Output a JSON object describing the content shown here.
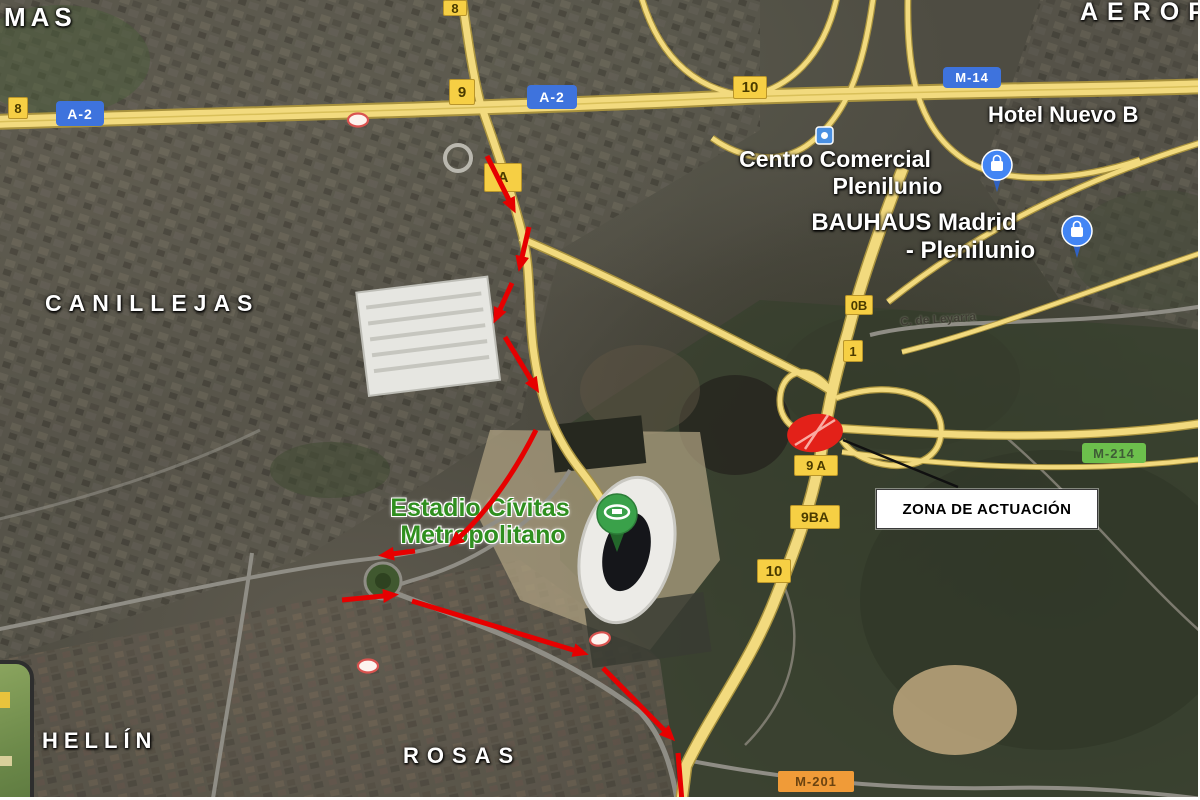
{
  "map_type": "satellite",
  "road_badges": {
    "exit_8_left": "8",
    "a2_left": "A-2",
    "exit_8_top": "8",
    "exit_9": "9",
    "a2_center": "A-2",
    "exit_10_top": "10",
    "exit_a": "A",
    "m14": "M-14",
    "exit_0b": "0B",
    "exit_1": "1",
    "exit_9a": "9 A",
    "exit_9ba": "9BA",
    "exit_10_mid": "10",
    "m214": "M-214",
    "m201": "M-201"
  },
  "place_labels": {
    "mas": "MAS",
    "aerop": "AEROP",
    "hotel_nuevo": "Hotel Nuevo B",
    "centro_comercial_1": "Centro Comercial",
    "centro_comercial_2": "Plenilunio",
    "bauhaus_1": "BAUHAUS Madrid",
    "bauhaus_2": "- Plenilunio",
    "canillejas": "CANILLEJAS",
    "street_leyarra": "C. de Leyarra",
    "estadio_1": "Estadio Cívitas",
    "estadio_2": "Metropolitano",
    "hellin": "HELLÍN",
    "rosas": "ROSAS"
  },
  "annotation": {
    "zona_label": "ZONA DE ACTUACIÓN"
  },
  "colors": {
    "exit_badge_yellow": "#f6cf44",
    "route_badge_blue": "#3e73dd",
    "route_badge_green": "#6cbf4c",
    "route_badge_orange": "#f09b38",
    "arrow_red": "#e60000",
    "zone_ellipse_red": "#e32119",
    "estadio_label_green": "#2f8f1f",
    "highway_yellow": "#f2da7e"
  },
  "icons": {
    "mall_pin": "shopping-bag-pin",
    "stadium_pin": "stadium-pin",
    "poi_square": "poi-square",
    "toll_oval": "road-restriction-oval"
  }
}
